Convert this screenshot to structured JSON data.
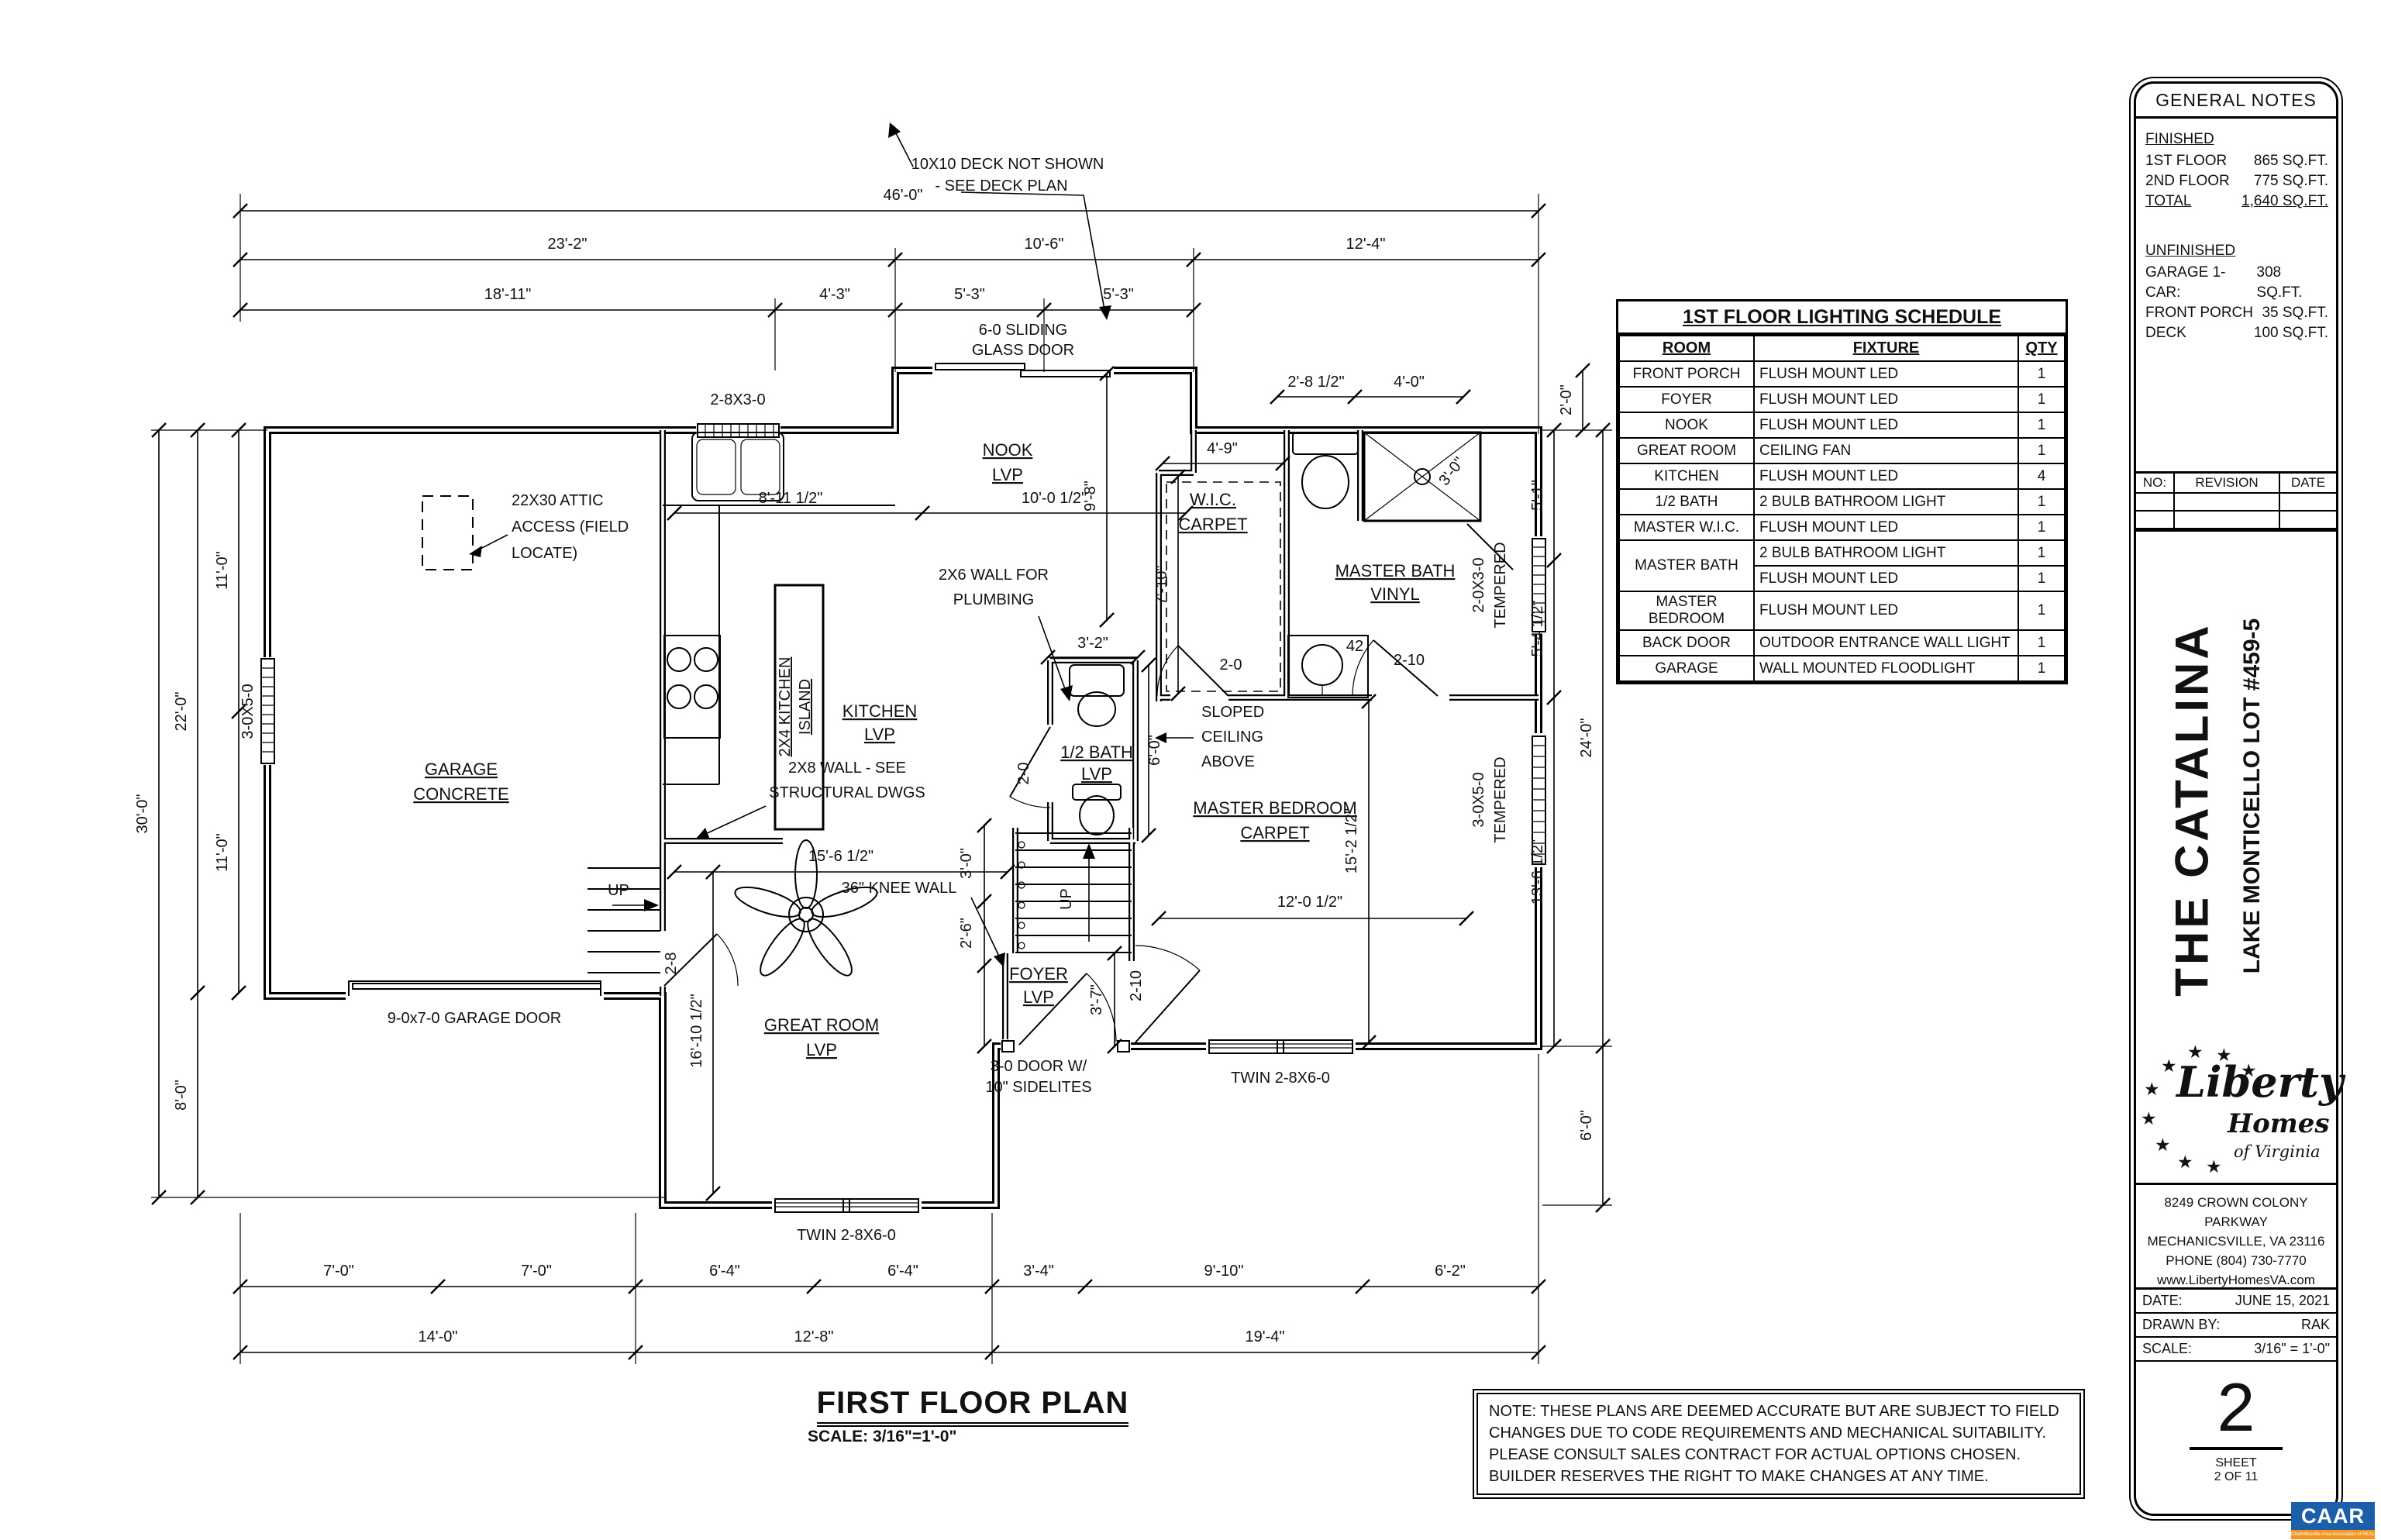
{
  "schedule": {
    "title": "1ST FLOOR LIGHTING SCHEDULE",
    "headers": [
      "ROOM",
      "FIXTURE",
      "QTY"
    ],
    "rows": [
      {
        "room": "FRONT PORCH",
        "fixture": "FLUSH MOUNT LED",
        "qty": "1"
      },
      {
        "room": "FOYER",
        "fixture": "FLUSH MOUNT LED",
        "qty": "1"
      },
      {
        "room": "NOOK",
        "fixture": "FLUSH MOUNT LED",
        "qty": "1"
      },
      {
        "room": "GREAT ROOM",
        "fixture": "CEILING FAN",
        "qty": "1"
      },
      {
        "room": "KITCHEN",
        "fixture": "FLUSH MOUNT LED",
        "qty": "4"
      },
      {
        "room": "1/2 BATH",
        "fixture": "2 BULB BATHROOM LIGHT",
        "qty": "1"
      },
      {
        "room": "MASTER W.I.C.",
        "fixture": "FLUSH MOUNT LED",
        "qty": "1"
      },
      {
        "room": "MASTER BATH",
        "fixture": "2 BULB BATHROOM LIGHT",
        "qty": "1"
      },
      {
        "room": "",
        "fixture": "FLUSH MOUNT LED",
        "qty": "1"
      },
      {
        "room": "MASTER BEDROOM",
        "fixture": "FLUSH MOUNT LED",
        "qty": "1"
      },
      {
        "room": "BACK DOOR",
        "fixture": "OUTDOOR ENTRANCE WALL LIGHT",
        "qty": "1"
      },
      {
        "room": "GARAGE",
        "fixture": "WALL MOUNTED FLOODLIGHT",
        "qty": "1"
      }
    ]
  },
  "general_notes": {
    "title": "GENERAL NOTES",
    "finished_label": "FINISHED",
    "finished": [
      {
        "label": "1ST FLOOR",
        "value": "865 SQ.FT."
      },
      {
        "label": "2ND FLOOR",
        "value": "775 SQ.FT."
      },
      {
        "label": "TOTAL",
        "value": "1,640 SQ.FT."
      }
    ],
    "unfinished_label": "UNFINISHED",
    "unfinished": [
      {
        "label": "GARAGE  1-CAR:",
        "value": "308 SQ.FT."
      },
      {
        "label": "FRONT PORCH",
        "value": "35 SQ.FT."
      },
      {
        "label": "DECK",
        "value": "100 SQ.FT."
      }
    ]
  },
  "revision": {
    "no": "NO:",
    "revision": "REVISION",
    "date": "DATE"
  },
  "titleblock": {
    "plan_name": "THE CATALINA",
    "lot": "LAKE MONTICELLO LOT #459-5",
    "logo": {
      "star": "★",
      "line1": "Liberty",
      "line2": "Homes",
      "line3": "of Virginia"
    },
    "address1": "8249 CROWN COLONY PARKWAY",
    "address2": "MECHANICSVILLE, VA 23116",
    "address3": "PHONE (804) 730-7770",
    "address4": "www.LibertyHomesVA.com",
    "date_label": "DATE:",
    "date": "JUNE 15, 2021",
    "drawn_label": "DRAWN BY:",
    "drawn": "RAK",
    "scale_label": "SCALE:",
    "scale": "3/16\" = 1'-0\"",
    "sheet_number": "2",
    "sheet_label": "SHEET",
    "sheet_of": "2 OF 11"
  },
  "caar": {
    "name": "CAAR",
    "tagline": "Charlottesville Area Association of REALTORS®"
  },
  "note_box": {
    "line1": "NOTE: THESE PLANS ARE DEEMED ACCURATE BUT ARE SUBJECT TO FIELD",
    "line2": "CHANGES DUE TO CODE REQUIREMENTS AND MECHANICAL SUITABILITY.",
    "line3": "PLEASE CONSULT SALES CONTRACT FOR ACTUAL OPTIONS CHOSEN.",
    "line4": "BUILDER RESERVES THE RIGHT TO MAKE CHANGES AT ANY TIME."
  },
  "plan": {
    "title": "FIRST FLOOR PLAN",
    "scale_note": "SCALE: 3/16\"=1'-0\"",
    "deck_note1": "10X10 DECK NOT SHOWN",
    "deck_note2": "- SEE DECK PLAN",
    "rooms": {
      "garage1": "GARAGE",
      "garage2": "CONCRETE",
      "kitchen1": "KITCHEN",
      "kitchen2": "LVP",
      "nook1": "NOOK",
      "nook2": "LVP",
      "great1": "GREAT ROOM",
      "great2": "LVP",
      "foyer1": "FOYER",
      "foyer2": "LVP",
      "half_bath1": "1/2 BATH",
      "half_bath2": "LVP",
      "wic1": "W.I.C.",
      "wic2": "CARPET",
      "mbath1": "MASTER BATH",
      "mbath2": "VINYL",
      "mbed1": "MASTER BEDROOM",
      "mbed2": "CARPET"
    },
    "annotations": {
      "attic1": "22X30 ATTIC",
      "attic2": "ACCESS (FIELD",
      "attic3": "LOCATE)",
      "slider1": "6-0 SLIDING",
      "slider2": "GLASS DOOR",
      "kitchen_window": "2-8X3-0",
      "garage_window": "3-0X5-0",
      "island1": "2X4 KITCHEN",
      "island2": "ISLAND",
      "plumb1": "2X6 WALL FOR",
      "plumb2": "PLUMBING",
      "struct1": "2X8 WALL - SEE",
      "struct2": "STRUCTURAL DWGS",
      "knee": "36\" KNEE WALL",
      "sloped1": "SLOPED",
      "sloped2": "CEILING",
      "sloped3": "ABOVE",
      "garage_door": "9-0x7-0 GARAGE DOOR",
      "front_door1": "3-0 DOOR W/",
      "front_door2": "10\" SIDELITES",
      "twin_window": "TWIN 2-8X6-0",
      "win_2030": "2-0X3-0",
      "win_3050": "3-0X5-0",
      "tempered": "TEMPERED",
      "up": "UP",
      "door_2_8": "2-8",
      "door_2_0": "2-0",
      "door_2_10": "2-10",
      "vanity": "42"
    },
    "dims": {
      "overall": "46'-0\"",
      "t23_2": "23'-2\"",
      "t10_6": "10'-6\"",
      "t12_4": "12'-4\"",
      "t18_11": "18'-11\"",
      "t4_3": "4'-3\"",
      "t5_3": "5'-3\"",
      "b7_0": "7'-0\"",
      "b6_4": "6'-4\"",
      "b3_4": "3'-4\"",
      "b9_10": "9'-10\"",
      "b6_2": "6'-2\"",
      "b14_0": "14'-0\"",
      "b12_8": "12'-8\"",
      "b19_4": "19'-4\"",
      "l30": "30'-0\"",
      "l22": "22'-0\"",
      "l8": "8'-0\"",
      "l11": "11'-0\"",
      "r5_1": "5'-1\"",
      "r5_4": "5'-4 1/2\"",
      "r13_6": "13'-6 1/2\"",
      "r24": "24'-0\"",
      "r6_0": "6'-0\"",
      "r2_0": "2'-0\"",
      "k8_11": "8'-11 1/2\"",
      "k10_0": "10'-0 1/2\"",
      "n9_8": "9'-8\"",
      "h3_2": "3'-2\"",
      "hb6_0": "6'-0\"",
      "wic4_9": "4'-9\"",
      "wic7_10": "7'-10\"",
      "mb2_8": "2'-8 1/2\"",
      "mb4_0": "4'-0\"",
      "sh3_0": "3'-0\"",
      "gr15_6": "15'-6 1/2\"",
      "gr16_10": "16'-10 1/2\"",
      "st3_0": "3'-0\"",
      "st2_6": "2'-6\"",
      "f3_7": "3'-7\"",
      "br15_2": "15'-2 1/2\"",
      "br12_0": "12'-0 1/2\""
    }
  }
}
